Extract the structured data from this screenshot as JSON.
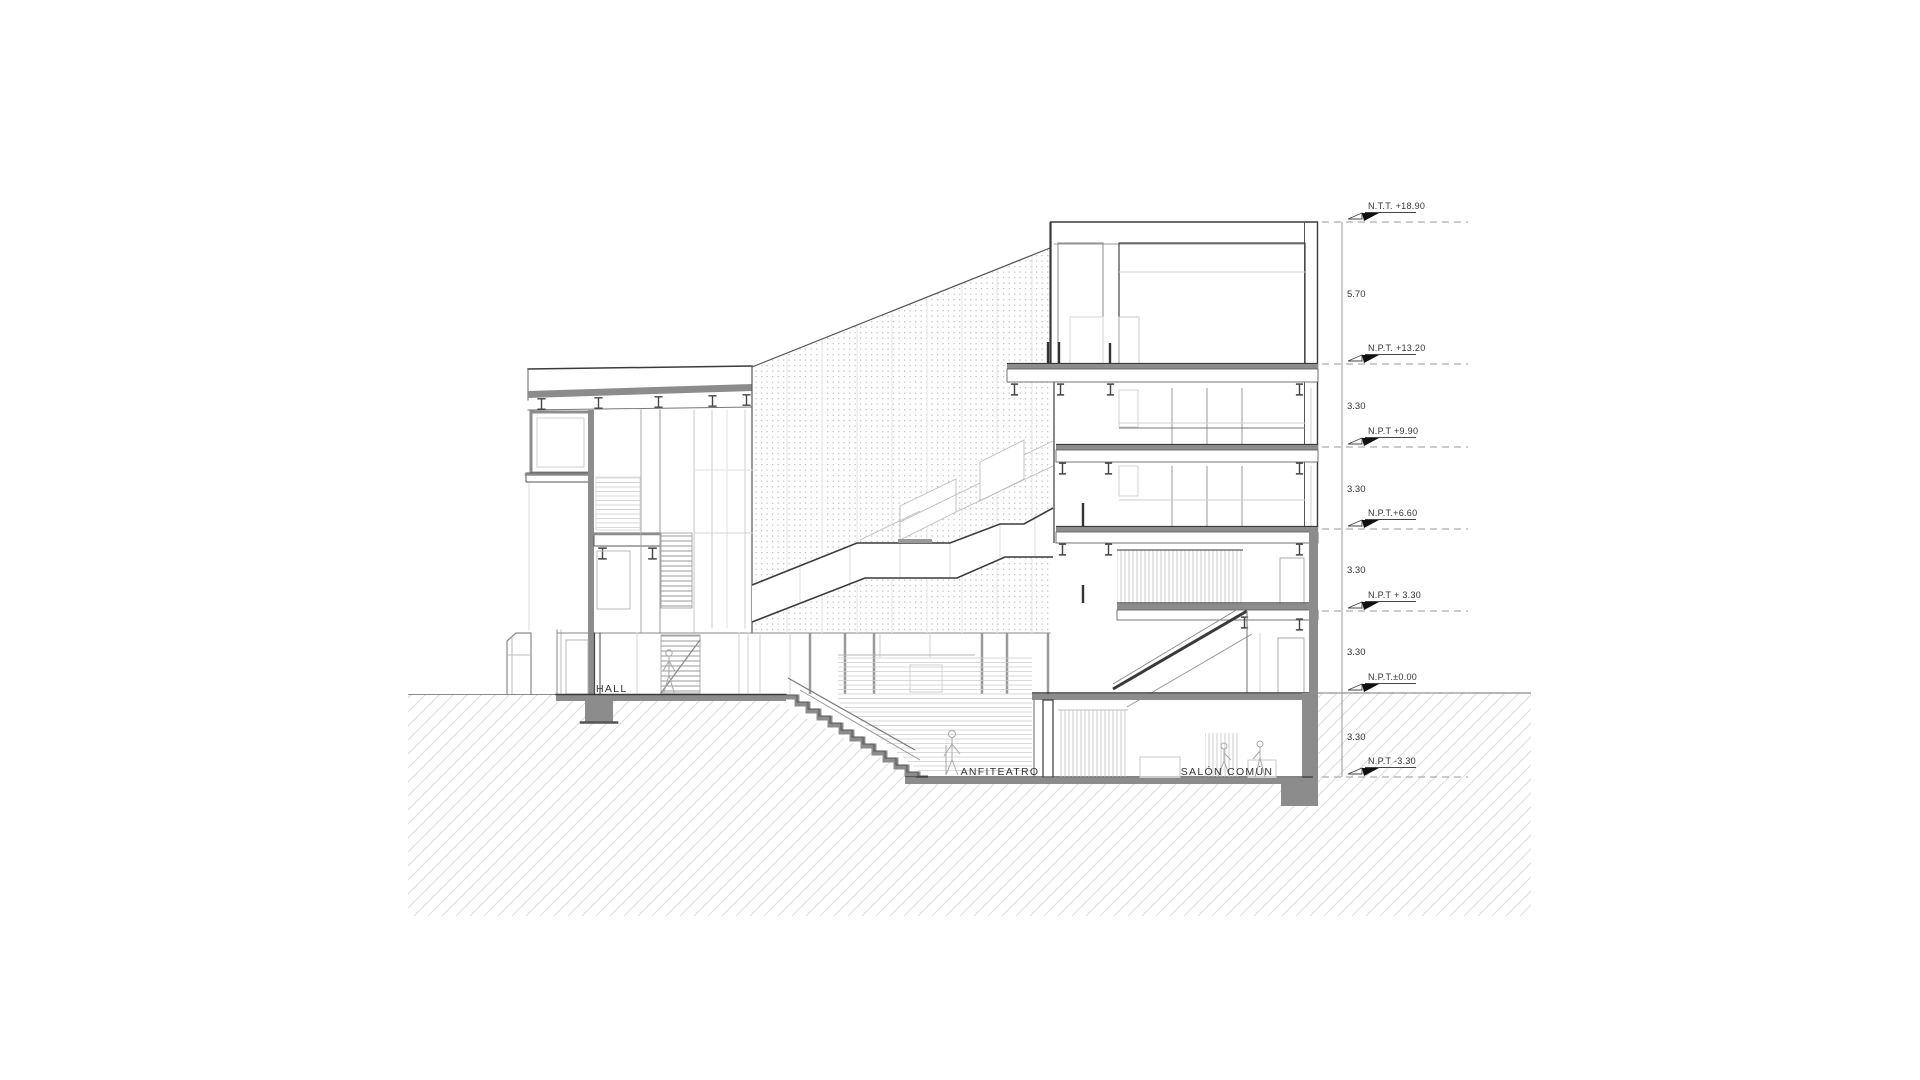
{
  "drawing": {
    "title": "building-section",
    "rooms": [
      {
        "label": "HALL"
      },
      {
        "label": "ANFITEATRO"
      },
      {
        "label": "SALÓN COMÚN"
      }
    ],
    "levels": [
      {
        "label": "N.T.T. +18.90",
        "value": "+18.90"
      },
      {
        "label": "N.P.T. +13.20",
        "value": "+13.20"
      },
      {
        "label": "N.P.T +9.90",
        "value": "+9.90"
      },
      {
        "label": "N.P.T.+6.60",
        "value": "+6.60"
      },
      {
        "label": "N.P.T + 3.30",
        "value": "+3.30"
      },
      {
        "label": "N.P.T.±0.00",
        "value": "±0.00"
      },
      {
        "label": "N.P.T -3.30",
        "value": "-3.30"
      }
    ],
    "dimensions": [
      {
        "label": "5.70"
      },
      {
        "label": "3.30"
      },
      {
        "label": "3.30"
      },
      {
        "label": "3.30"
      },
      {
        "label": "3.30"
      },
      {
        "label": "3.30"
      }
    ],
    "colors": {
      "background": "#ffffff",
      "line_dark": "#3a3a3a",
      "line_mid": "#8a8a8a",
      "line_light": "#c9c9c9",
      "poche_gray": "#8c8c8c",
      "hatch_gray": "#dcdcdc",
      "dot_gray": "#c4c4c4"
    }
  }
}
